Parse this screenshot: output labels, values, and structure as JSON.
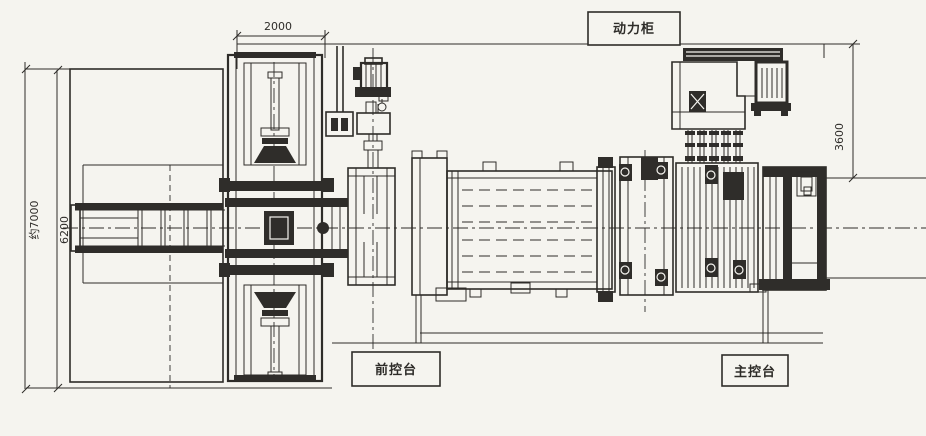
{
  "drawing": {
    "labels": {
      "power_cabinet": "动力柜",
      "front_console": "前控台",
      "main_console": "主控台"
    },
    "dimensions": {
      "top_span": "2000",
      "overall_height": "约7000",
      "bed_height": "6200",
      "cabinet_offset": "3600"
    },
    "colors": {
      "paper": "#f5f4ef",
      "ink": "#2e2c29",
      "dark_fill": "#2f2d2a"
    }
  }
}
